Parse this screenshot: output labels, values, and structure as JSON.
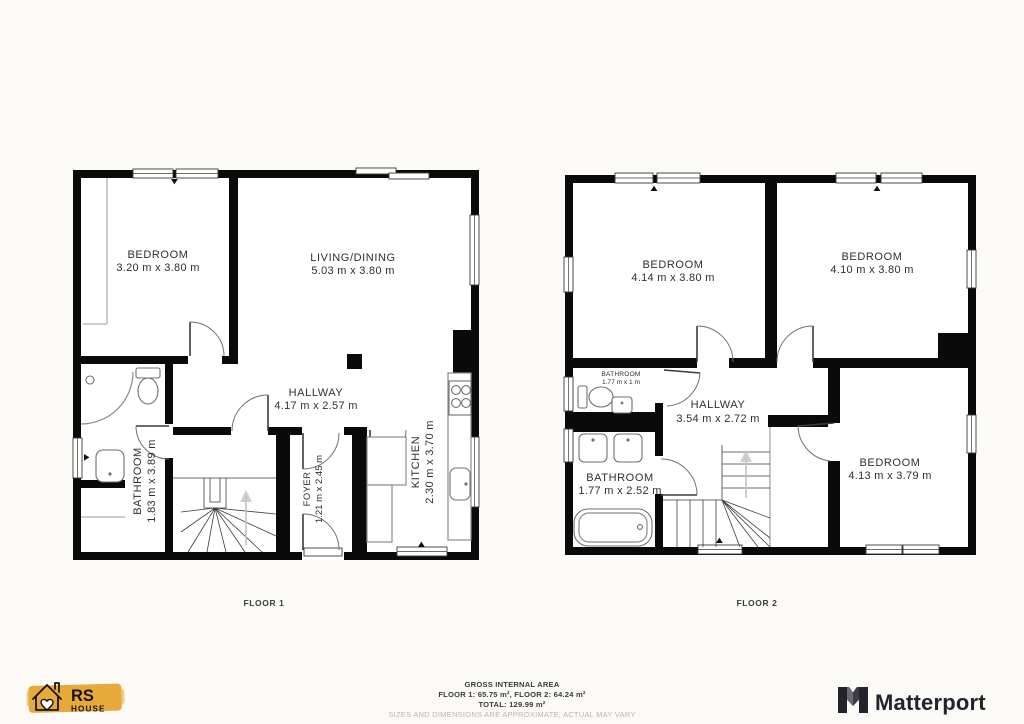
{
  "page": {
    "background": "#fbfaf7"
  },
  "floor1": {
    "label": "FLOOR 1",
    "rooms": {
      "bedroom": {
        "name": "BEDROOM",
        "dims": "3.20 m x 3.80 m"
      },
      "living_dining": {
        "name": "LIVING/DINING",
        "dims": "5.03 m x 3.80 m"
      },
      "hallway": {
        "name": "HALLWAY",
        "dims": "4.17 m x 2.57 m"
      },
      "bathroom": {
        "name": "BATHROOM",
        "dims": "1.83 m x 3.89 m"
      },
      "foyer": {
        "name": "FOYER",
        "dims": "1.21 m x 2.45 m"
      },
      "kitchen": {
        "name": "KITCHEN",
        "dims": "2.30 m x 3.70 m"
      }
    }
  },
  "floor2": {
    "label": "FLOOR 2",
    "rooms": {
      "bedroom_top_left": {
        "name": "BEDROOM",
        "dims": "4.14 m x 3.80 m"
      },
      "bedroom_top_right": {
        "name": "BEDROOM",
        "dims": "4.10 m x 3.80 m"
      },
      "bathroom_small": {
        "name": "BATHROOM",
        "dims": "1.77 m x 1 m"
      },
      "hallway": {
        "name": "HALLWAY",
        "dims": "3.54 m x 2.72 m"
      },
      "bathroom": {
        "name": "BATHROOM",
        "dims": "1.77 m x 2.52 m"
      },
      "bedroom_right": {
        "name": "BEDROOM",
        "dims": "4.13 m x 3.79 m"
      }
    }
  },
  "footer": {
    "title": "GROSS INTERNAL AREA",
    "areas": "FLOOR 1: 65.75 m², FLOOR 2: 64.24 m²",
    "total": "TOTAL: 129.99 m²",
    "disclaimer": "SIZES AND DIMENSIONS ARE APPROXIMATE, ACTUAL MAY VARY"
  },
  "branding": {
    "rs_house": {
      "name": "RS",
      "sub": "HOUSE",
      "accent": "#e7a93b"
    },
    "matterport": {
      "label": "Matterport",
      "color": "#23232b"
    }
  },
  "colors": {
    "wall": "#0a0a0a",
    "plan_floor": "#ffffff",
    "label_text": "#2f2f2f",
    "fixture_stroke": "#8c8c8c",
    "disclaimer_text": "#bcb6ac"
  }
}
